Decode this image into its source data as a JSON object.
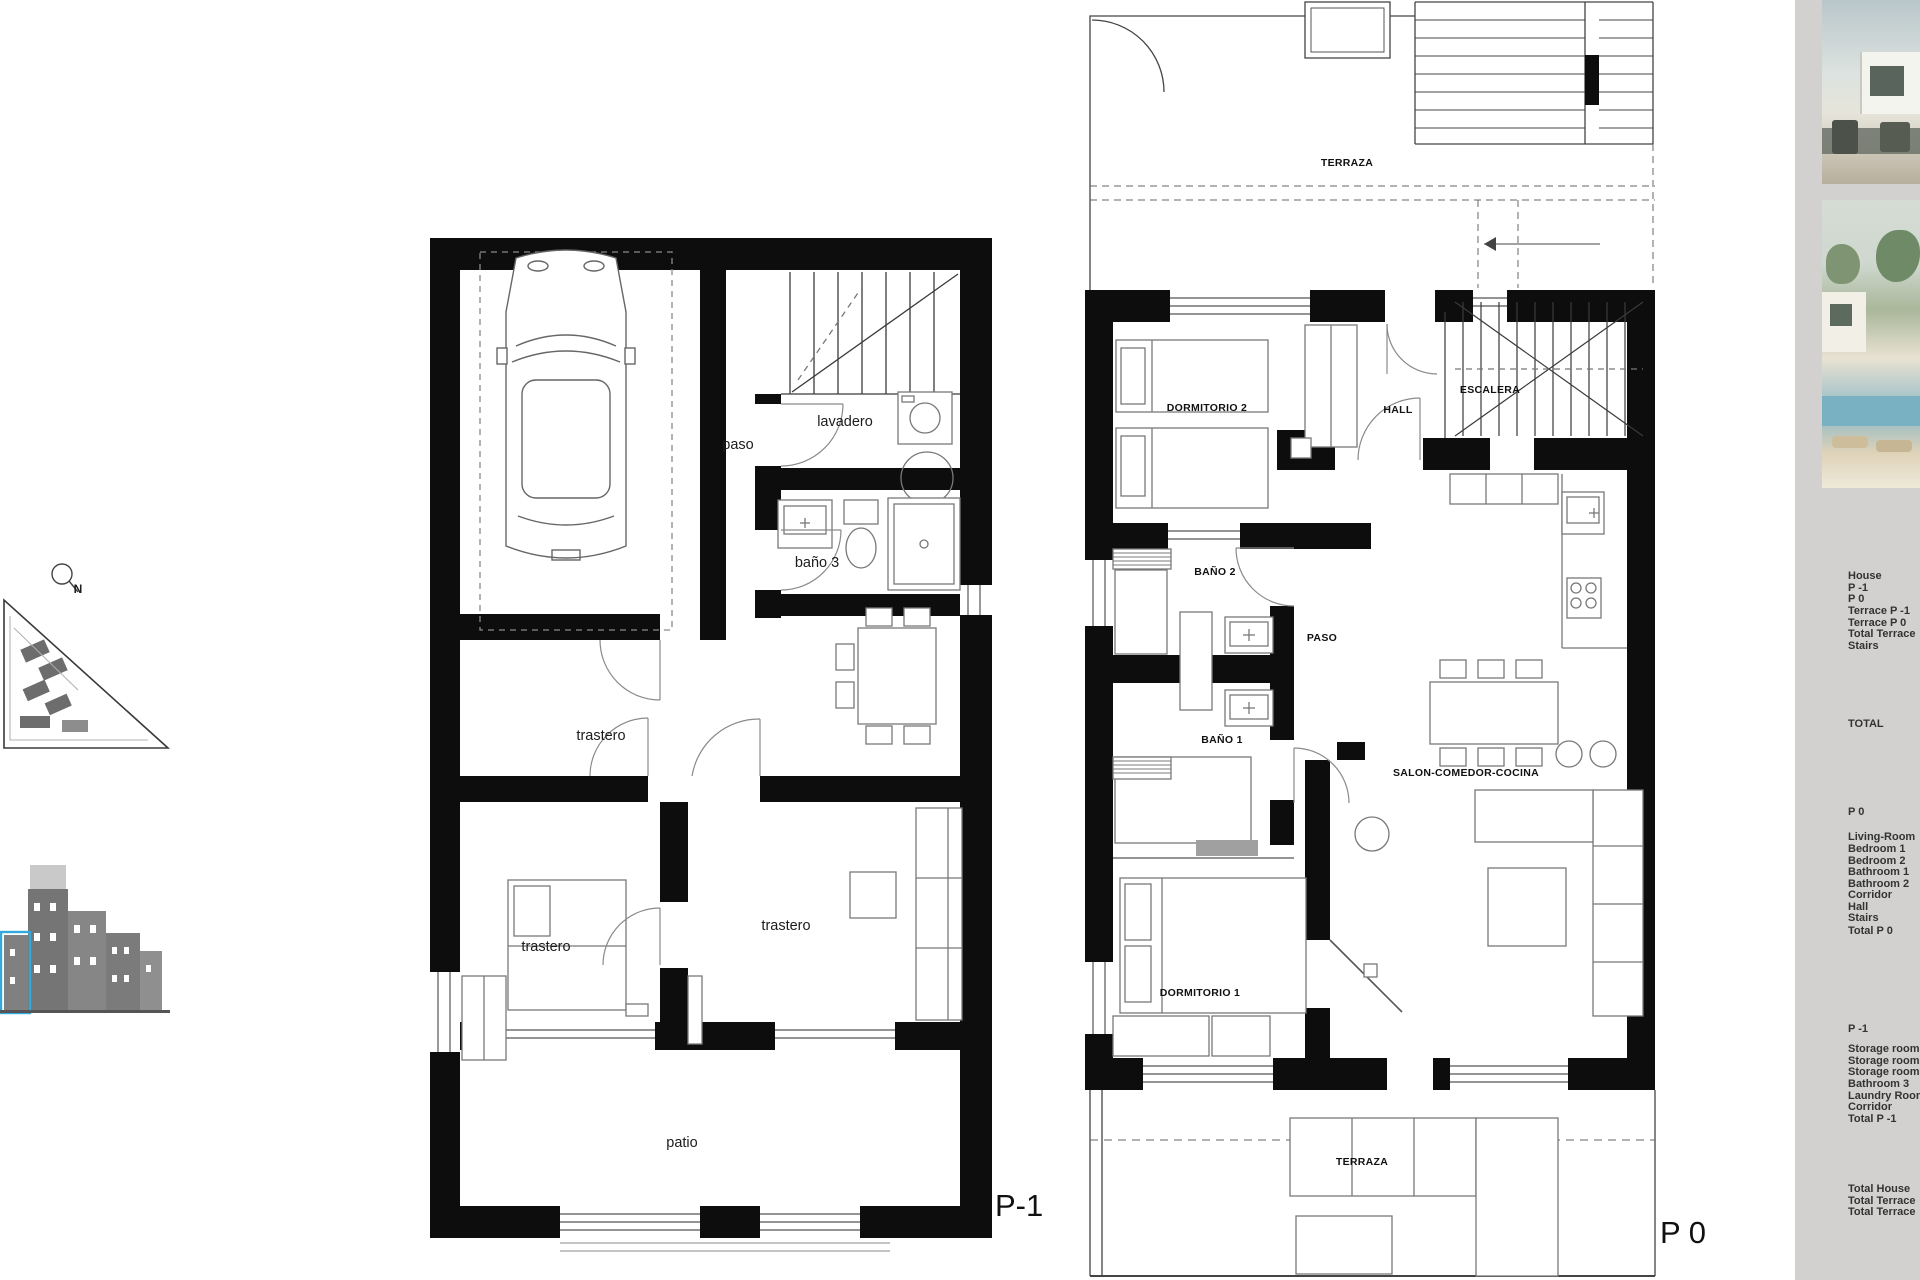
{
  "plans": {
    "p1": {
      "name": "P-1",
      "labels": {
        "paso": "paso",
        "lavadero": "lavadero",
        "bano3": "baño 3",
        "trastero_mid": "trastero",
        "trastero_left": "trastero",
        "trastero_right": "trastero",
        "patio": "patio"
      }
    },
    "p0": {
      "name": "P 0",
      "labels": {
        "terraza_top": "TERRAZA",
        "dormitorio2": "DORMITORIO 2",
        "hall": "HALL",
        "escalera": "ESCALERA",
        "bano2": "BAÑO 2",
        "paso": "PASO",
        "bano1": "BAÑO 1",
        "salon": "SALON-COMEDOR-COCINA",
        "dormitorio1": "DORMITORIO 1",
        "terraza_bottom": "TERRAZA"
      }
    }
  },
  "site": {
    "compass_north": "N"
  },
  "sidebar": {
    "rows": [
      "House",
      "P -1",
      "P 0",
      "Terrace P -1",
      "Terrace P 0",
      "Total Terrace",
      "Stairs",
      "TOTAL",
      "P 0",
      "Living-Room",
      "Bedroom 1",
      "Bedroom 2",
      "Bathroom 1",
      "Bathroom 2",
      "Corridor",
      "Hall",
      "Stairs",
      "Total  P 0",
      "P -1",
      "Storage room",
      "Storage room",
      "Storage room",
      "Bathroom 3",
      "Laundry Room",
      "Corridor",
      "Total  P -1",
      "Total  House",
      "Total  Terrace",
      "Total  Terrace"
    ]
  },
  "colors": {
    "wall": "#0d0d0d",
    "line": "#3a3a3a",
    "furniture": "#787878",
    "sidebar_bg": "#d2d1d0",
    "accent_blue": "#35a8dc"
  }
}
